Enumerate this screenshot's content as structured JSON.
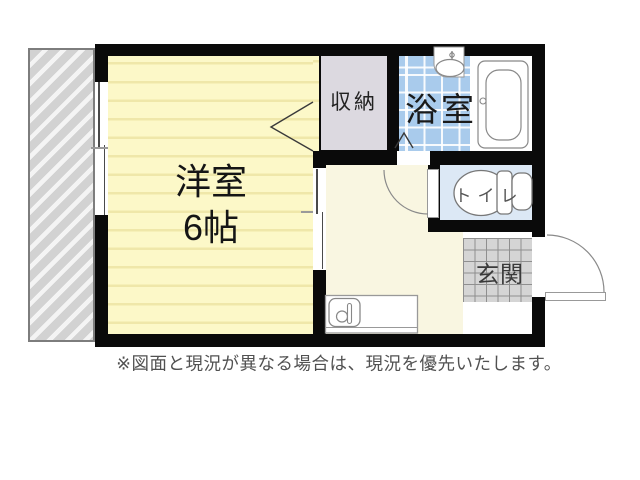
{
  "floorplan": {
    "rooms": {
      "main_room": {
        "name_label": "洋室",
        "size_label": "6帖"
      },
      "closet": {
        "label": "収納"
      },
      "bathroom": {
        "label": "浴室"
      },
      "toilet": {
        "label": "トイレ"
      },
      "entrance": {
        "label": "玄関"
      }
    },
    "disclaimer": "※図面と現況が異なる場合は、現況を優先いたします。",
    "colors": {
      "wall": "#0a0a0a",
      "main_room_fill": "#fcf8c8",
      "main_room_stripe": "#efe7a9",
      "closet_fill": "#dcd9e0",
      "bath_tile_fill": "#a9cbec",
      "toilet_fill": "#dce8f5",
      "hallway_fill": "#f9f6e1",
      "entrance_tile_fill": "#d5d5d5",
      "balcony_fill": "#d2d2d2"
    }
  }
}
